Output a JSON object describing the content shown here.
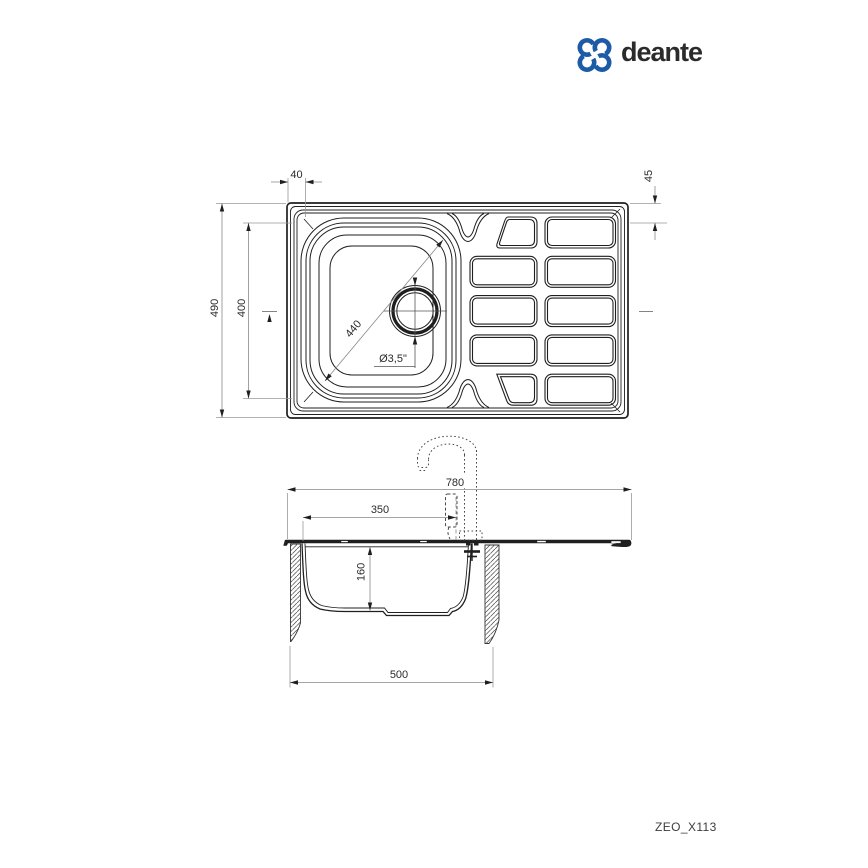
{
  "logo": {
    "brand": "deante",
    "color": "#1d5ba7"
  },
  "product_code": "ZEO_X113",
  "top_view": {
    "dimensions": {
      "rim_to_bowl_offset": "40",
      "rim_to_drainer_offset": "45",
      "overall_depth": "490",
      "bowl_outer_size": "400",
      "bowl_diagonal": "440",
      "drain_diameter": "Ø3,5\""
    }
  },
  "section_view": {
    "dimensions": {
      "overall_width": "780",
      "tap_hole_distance": "350",
      "bowl_depth": "160",
      "min_cabinet_width": "500"
    }
  }
}
